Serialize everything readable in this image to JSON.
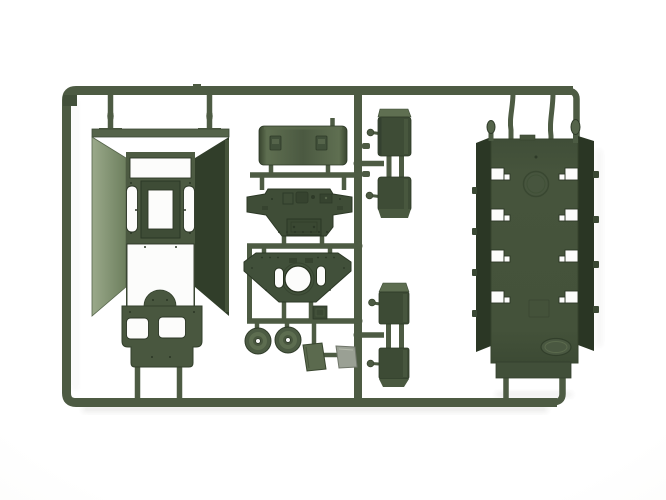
{
  "meta": {
    "description": "Product photograph of an olive-green injection-molded plastic model kit sprue containing armored-vehicle hull parts, on a plain white background",
    "visible_text": "",
    "logo": "unreadable oval embossed maker logo on deck panel"
  },
  "palette": {
    "bg": "#ffffff",
    "runner": "#4d5b43",
    "runner_dark": "#39452f",
    "plastic": "#46543c",
    "plastic_dark": "#35412d",
    "plastic_deep": "#2b3725",
    "plastic_light": "#5c6b4e",
    "plastic_lit": "#8a9a7c",
    "grey_part": "#9aa094",
    "white_cut": "#fcfcfb",
    "shadow": "#6b6b66"
  },
  "parts": {
    "frame": {
      "label": "Sprue runner frame"
    },
    "hull_tub": {
      "label": "Lower hull tub (left)"
    },
    "curved_panel": {
      "label": "Curved hull roof panel"
    },
    "rear_plate": {
      "label": "Rear hull plate with hatches"
    },
    "turret_ring_plate": {
      "label": "Upper hull plate with turret ring opening"
    },
    "road_wheels": {
      "label": "Road wheels (pair)"
    },
    "hatch_block": {
      "label": "Small hatch block"
    },
    "mud_flaps": {
      "label": "Mud flaps (olive + grey)"
    },
    "stowage_boxes_upper": {
      "label": "Stowage boxes, upper pair"
    },
    "stowage_boxes_lower": {
      "label": "Stowage boxes, lower pair"
    },
    "deck_panel": {
      "label": "Hull deck panel with notched rails (right)"
    }
  }
}
